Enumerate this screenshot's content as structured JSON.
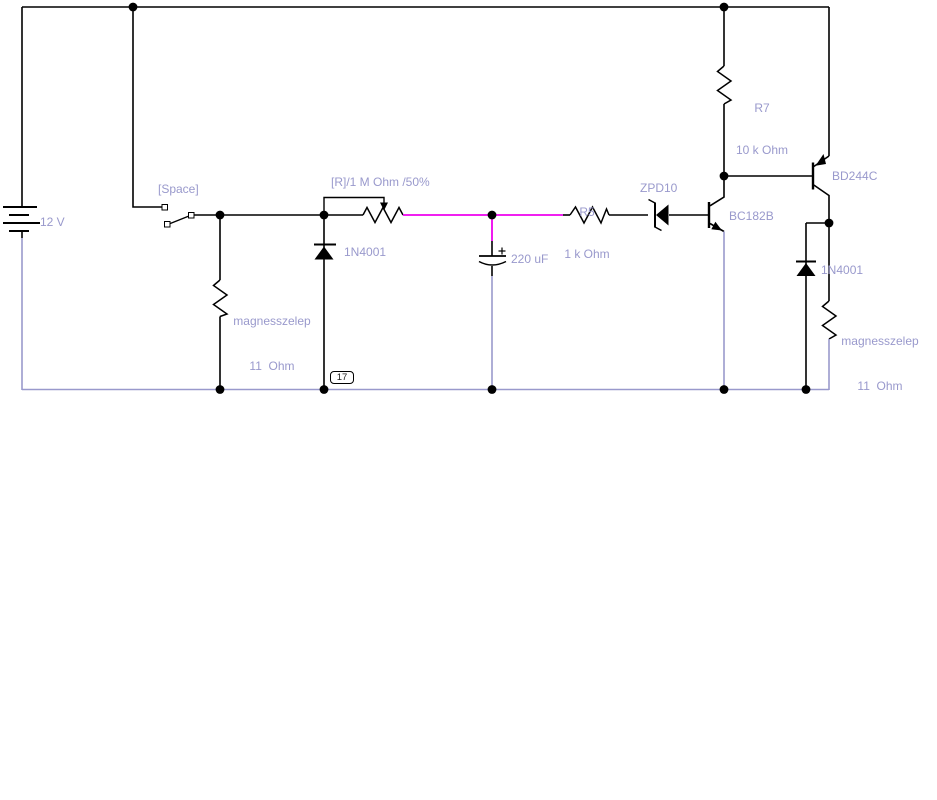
{
  "diagram": {
    "background": "#FFFFFF",
    "colors": {
      "wire": "#000000",
      "highlight_net": "#EE00EE",
      "return_net": "#9999CC",
      "label_text": "#9999CC"
    },
    "node_badge": "17",
    "components": {
      "battery": {
        "value": "12 V"
      },
      "switch": {
        "label": "[Space]"
      },
      "potentiometer": {
        "label": "[R]/1 M Ohm /50%"
      },
      "diode_left": {
        "label": "1N4001"
      },
      "solenoid_left": {
        "name": "magnesszelep",
        "value": "11  Ohm"
      },
      "capacitor": {
        "value": "220 uF"
      },
      "resistor_r5": {
        "ref": "R5",
        "value": "1 k Ohm"
      },
      "zener": {
        "label": "ZPD10"
      },
      "transistor_npn": {
        "label": "BC182B"
      },
      "resistor_r7": {
        "ref": "R7",
        "value": "10 k Ohm"
      },
      "transistor_pnp": {
        "label": "BD244C"
      },
      "diode_right": {
        "label": "1N4001"
      },
      "solenoid_right": {
        "name": "magnesszelep",
        "value": "11  Ohm"
      }
    }
  }
}
